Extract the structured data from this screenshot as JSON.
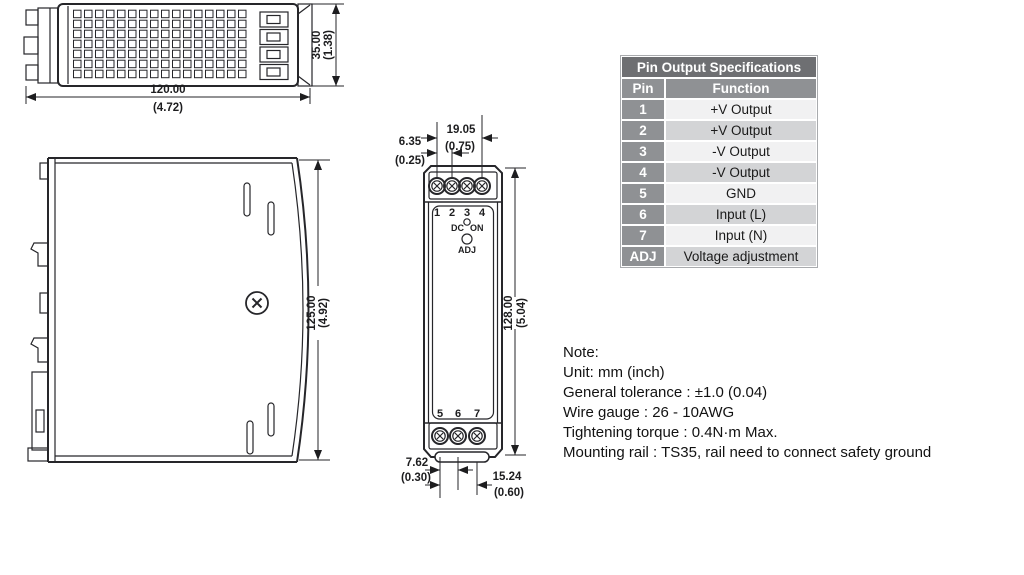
{
  "top_view": {
    "width_mm": "120.00",
    "width_in": "(4.72)",
    "depth_mm": "35.00",
    "depth_in": "(1.38)"
  },
  "side_view": {
    "height_mm": "125.00",
    "height_in": "(4.92)"
  },
  "front_view": {
    "pins_top": [
      "1",
      "2",
      "3",
      "4"
    ],
    "pins_bottom": [
      "5",
      "6",
      "7"
    ],
    "led_left": "DC",
    "led_right": "ON",
    "adj_label": "ADJ",
    "span_top_mm": "19.05",
    "span_top_in": "(0.75)",
    "pitch_top_mm": "6.35",
    "pitch_top_in": "(0.25)",
    "height_mm": "128.00",
    "height_in": "(5.04)",
    "pitch_bottom_mm": "7.62",
    "pitch_bottom_in": "(0.30)",
    "span_bottom_mm": "15.24",
    "span_bottom_in": "(0.60)"
  },
  "table": {
    "title": "Pin Output Specifications",
    "col_pin": "Pin",
    "col_function": "Function",
    "rows": [
      {
        "pin": "1",
        "function": "+V Output"
      },
      {
        "pin": "2",
        "function": "+V Output"
      },
      {
        "pin": "3",
        "function": "-V Output"
      },
      {
        "pin": "4",
        "function": "-V Output"
      },
      {
        "pin": "5",
        "function": "GND"
      },
      {
        "pin": "6",
        "function": "Input (L)"
      },
      {
        "pin": "7",
        "function": "Input (N)"
      },
      {
        "pin": "ADJ",
        "function": "Voltage adjustment"
      }
    ]
  },
  "notes": {
    "heading": "Note:",
    "lines": [
      "Unit: mm (inch)",
      "General tolerance : ±1.0 (0.04)",
      "Wire gauge : 26 - 10AWG",
      "Tightening torque : 0.4N·m Max.",
      "Mounting rail : TS35, rail need to connect safety ground"
    ]
  }
}
